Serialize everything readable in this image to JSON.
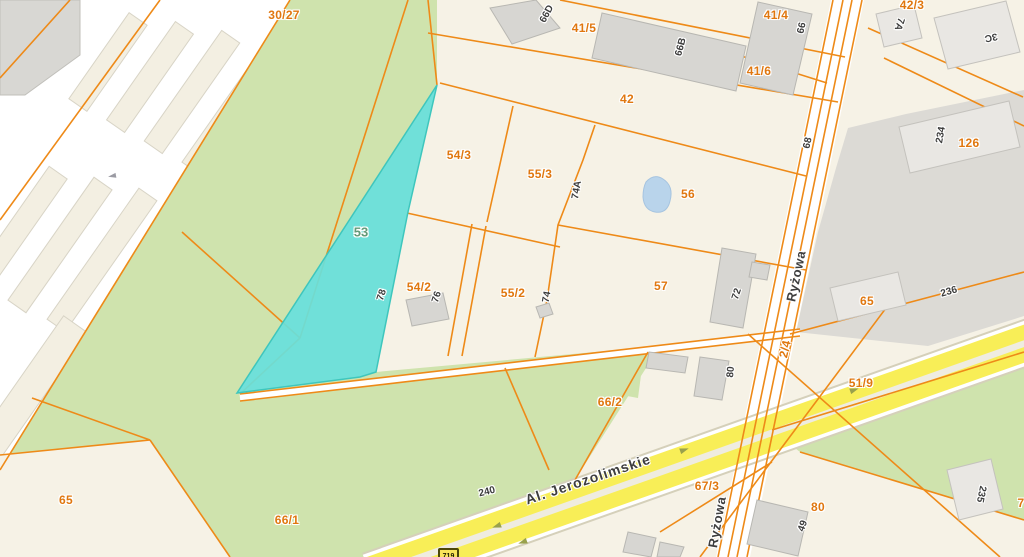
{
  "map": {
    "type": "cadastral-parcel-map",
    "highlighted_parcel": "53",
    "streets": {
      "jerozolimskie": "Al. Jerozolimskie",
      "ryzowa_mid": "Ryżowa",
      "ryzowa_bottom": "Ryżowa"
    },
    "route_badge": "719",
    "parcel_labels": {
      "p30_27": "30/27",
      "p41_5": "41/5",
      "p41_4": "41/4",
      "p42_3": "42/3",
      "p41_6": "41/6",
      "p42": "42",
      "p126": "126",
      "p54_3": "54/3",
      "p55_3": "55/3",
      "p56": "56",
      "p53": "53",
      "p54_2": "54/2",
      "p55_2": "55/2",
      "p57": "57",
      "p65_right": "65",
      "p51_9": "51/9",
      "p66_2": "66/2",
      "p67_3": "67/3",
      "p80": "80",
      "p66_1": "66/1",
      "p65_bottom": "65",
      "p2_4": "2/4",
      "p7": "7"
    },
    "building_numbers": {
      "b66d": "66D",
      "b66b": "66B",
      "b66": "66",
      "b7a": "7A",
      "b3c": "3C",
      "b234": "234",
      "b74a": "74A",
      "b68": "68",
      "b78": "78",
      "b76": "76",
      "b74": "74",
      "b72": "72",
      "b80": "80",
      "b240": "240",
      "b236": "236",
      "b49": "49",
      "b235": "235"
    },
    "colors": {
      "parcel_line": "#ee8a18",
      "parcel_label": "#e0770f",
      "highlight_fill": "#68e0dc",
      "highlight_stroke": "#3ec6bd",
      "green_area": "#cfe3ad",
      "road_yellow": "#f8ee57",
      "building_gray": "#d7d6d2",
      "industrial_gray": "#dcdad5",
      "pond_blue": "#b9d4eb",
      "label_dark": "#3c3c3c"
    }
  }
}
